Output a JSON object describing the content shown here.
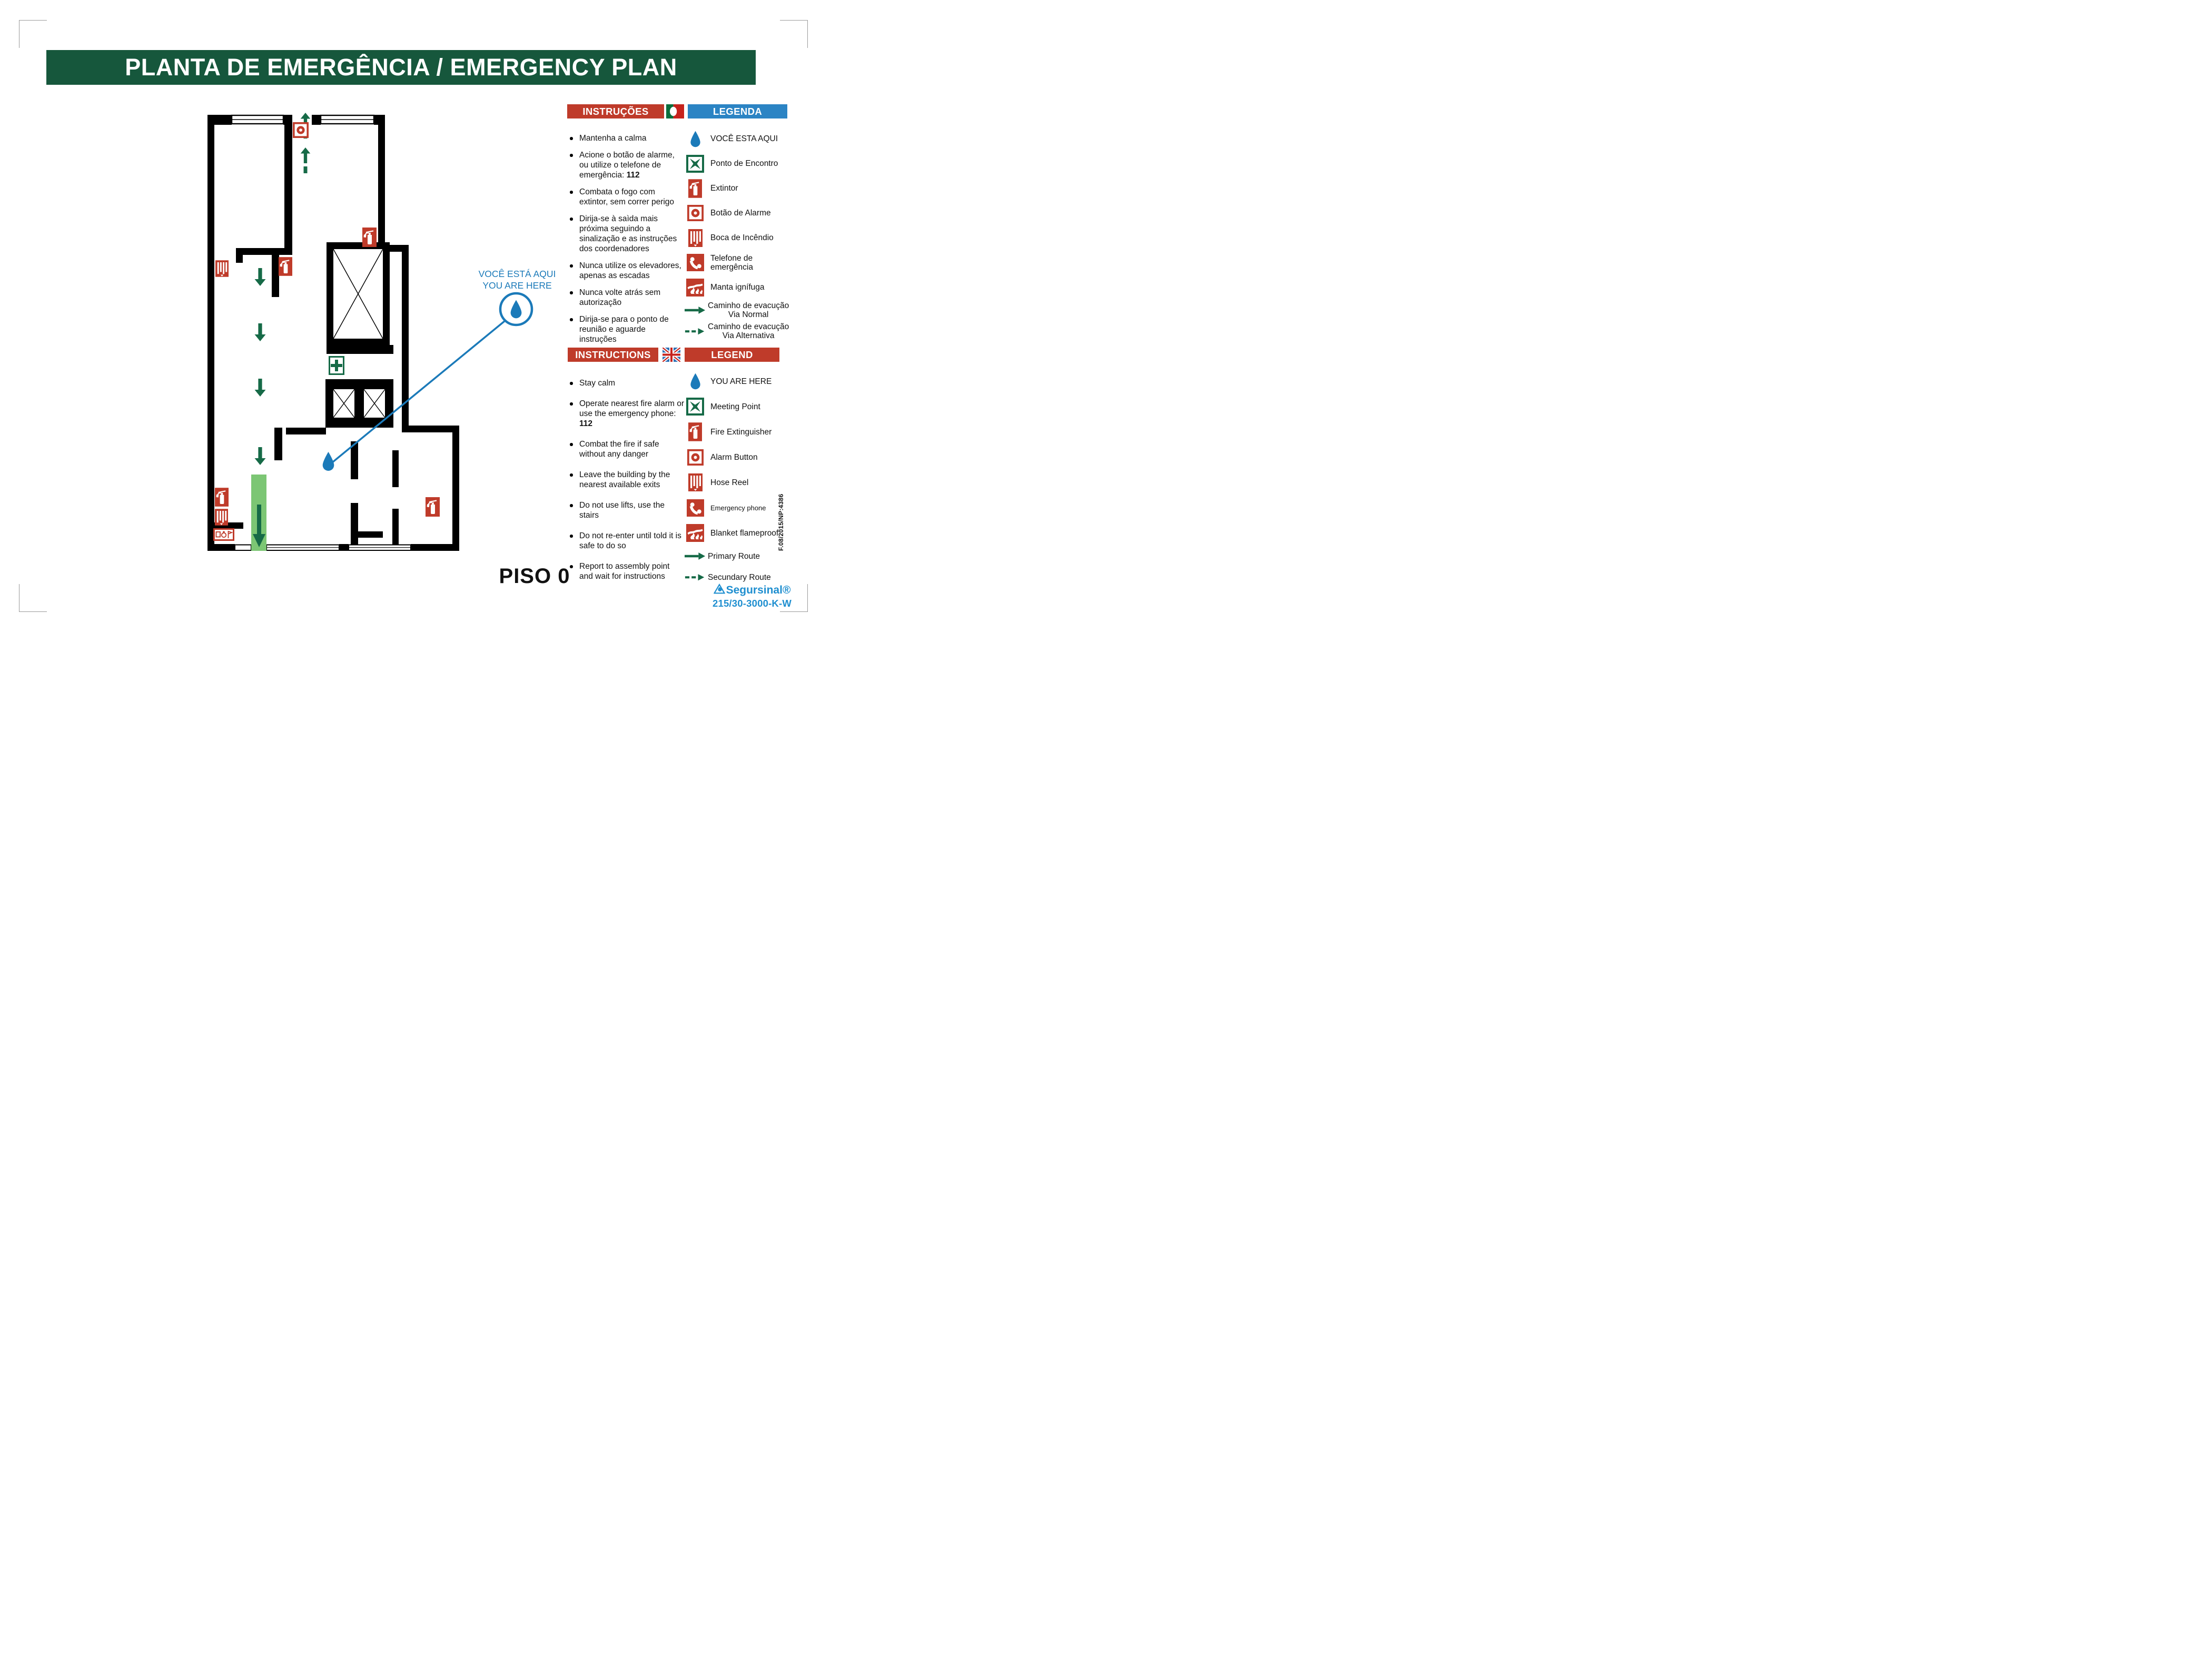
{
  "page": {
    "title": "PLANTA DE EMERGÊNCIA / EMERGENCY PLAN",
    "floor_label": "PISO 0"
  },
  "callout": {
    "line1": "VOCÊ ESTÁ AQUI",
    "line2": "YOU ARE HERE"
  },
  "pt": {
    "instructions_title": "INSTRUÇÕES",
    "legend_title": "LEGENDA",
    "flag_icon": "portugal-flag",
    "instructions": [
      {
        "pre": "Mantenha a calma",
        "strong": ""
      },
      {
        "pre": "Acione o botão de alarme, ou utilize o telefone de emergência: ",
        "strong": "112"
      },
      {
        "pre": "Combata o fogo com extintor, sem correr perigo",
        "strong": ""
      },
      {
        "pre": "Dirija-se à saìda mais próxima seguindo a sinalização e as instruções dos coordenadores",
        "strong": ""
      },
      {
        "pre": "Nunca utilize os elevadores, apenas as escadas",
        "strong": ""
      },
      {
        "pre": "Nunca volte atrás sem autorização",
        "strong": ""
      },
      {
        "pre": "Dirija-se para o ponto de reunião e aguarde instruções",
        "strong": ""
      }
    ],
    "legend": [
      {
        "icon": "you-are-here-drop",
        "label": "VOCÊ ESTA AQUI",
        "label2": ""
      },
      {
        "icon": "meeting-point",
        "label": "Ponto de Encontro",
        "label2": ""
      },
      {
        "icon": "fire-extinguisher",
        "label": "Extintor",
        "label2": ""
      },
      {
        "icon": "alarm-button",
        "label": "Botão de Alarme",
        "label2": ""
      },
      {
        "icon": "hose-reel",
        "label": "Boca de Incêndio",
        "label2": ""
      },
      {
        "icon": "emergency-phone",
        "label": "Telefone de emergência",
        "label2": ""
      },
      {
        "icon": "fire-blanket",
        "label": "Manta ignífuga",
        "label2": ""
      },
      {
        "icon": "route-primary-arrow",
        "label": "Caminho de evacução",
        "label2": "Via Normal"
      },
      {
        "icon": "route-secondary-arrow",
        "label": "Caminho de evacução",
        "label2": "Via Alternativa"
      }
    ]
  },
  "en": {
    "instructions_title": "INSTRUCTIONS",
    "legend_title": "LEGEND",
    "flag_icon": "uk-flag",
    "instructions": [
      {
        "pre": "Stay calm",
        "strong": ""
      },
      {
        "pre": "Operate nearest fire alarm or use the emergency phone: ",
        "strong": "112"
      },
      {
        "pre": "Combat the fire if safe without any danger",
        "strong": ""
      },
      {
        "pre": "Leave the building by the nearest available exits",
        "strong": ""
      },
      {
        "pre": "Do not use lifts, use the stairs",
        "strong": ""
      },
      {
        "pre": "Do not re-enter until told it is safe to do so",
        "strong": ""
      },
      {
        "pre": "Report to assembly point and wait for instructions",
        "strong": ""
      }
    ],
    "legend": [
      {
        "icon": "you-are-here-drop",
        "label": "YOU ARE HERE",
        "label2": ""
      },
      {
        "icon": "meeting-point",
        "label": "Meeting Point",
        "label2": ""
      },
      {
        "icon": "fire-extinguisher",
        "label": "Fire Extinguisher",
        "label2": ""
      },
      {
        "icon": "alarm-button",
        "label": "Alarm Button",
        "label2": ""
      },
      {
        "icon": "hose-reel",
        "label": "Hose Reel",
        "label2": ""
      },
      {
        "icon": "emergency-phone",
        "label": "Emergency phone",
        "label2": ""
      },
      {
        "icon": "fire-blanket",
        "label": "Blanket flameproof",
        "label2": ""
      },
      {
        "icon": "route-primary-arrow",
        "label": "Primary Route",
        "label2": ""
      },
      {
        "icon": "route-secondary-arrow",
        "label": "Secundary Route",
        "label2": ""
      }
    ]
  },
  "plan": {
    "markers": [
      "alarm-button",
      "fire-extinguisher",
      "hose-reel",
      "first-aid-kit",
      "stairwell",
      "lift",
      "lift",
      "fire-extinguisher",
      "fire-extinguisher",
      "hose-reel",
      "safety-signage-panel",
      "fire-extinguisher",
      "you-are-here-marker",
      "exit-path-band"
    ]
  },
  "footer": {
    "doc_ref": "F.08/2015/NP:4386",
    "brand": "Segursinal®",
    "product_code": "215/30-3000-K-W"
  },
  "colors": {
    "header_green": "#16573c",
    "signal_red": "#bf3b2a",
    "legend_blue": "#2b84c4",
    "marker_blue": "#1b7ab9",
    "route_green": "#166a47",
    "exit_band_green": "#7cc674",
    "brand_blue": "#1f8fd0"
  }
}
